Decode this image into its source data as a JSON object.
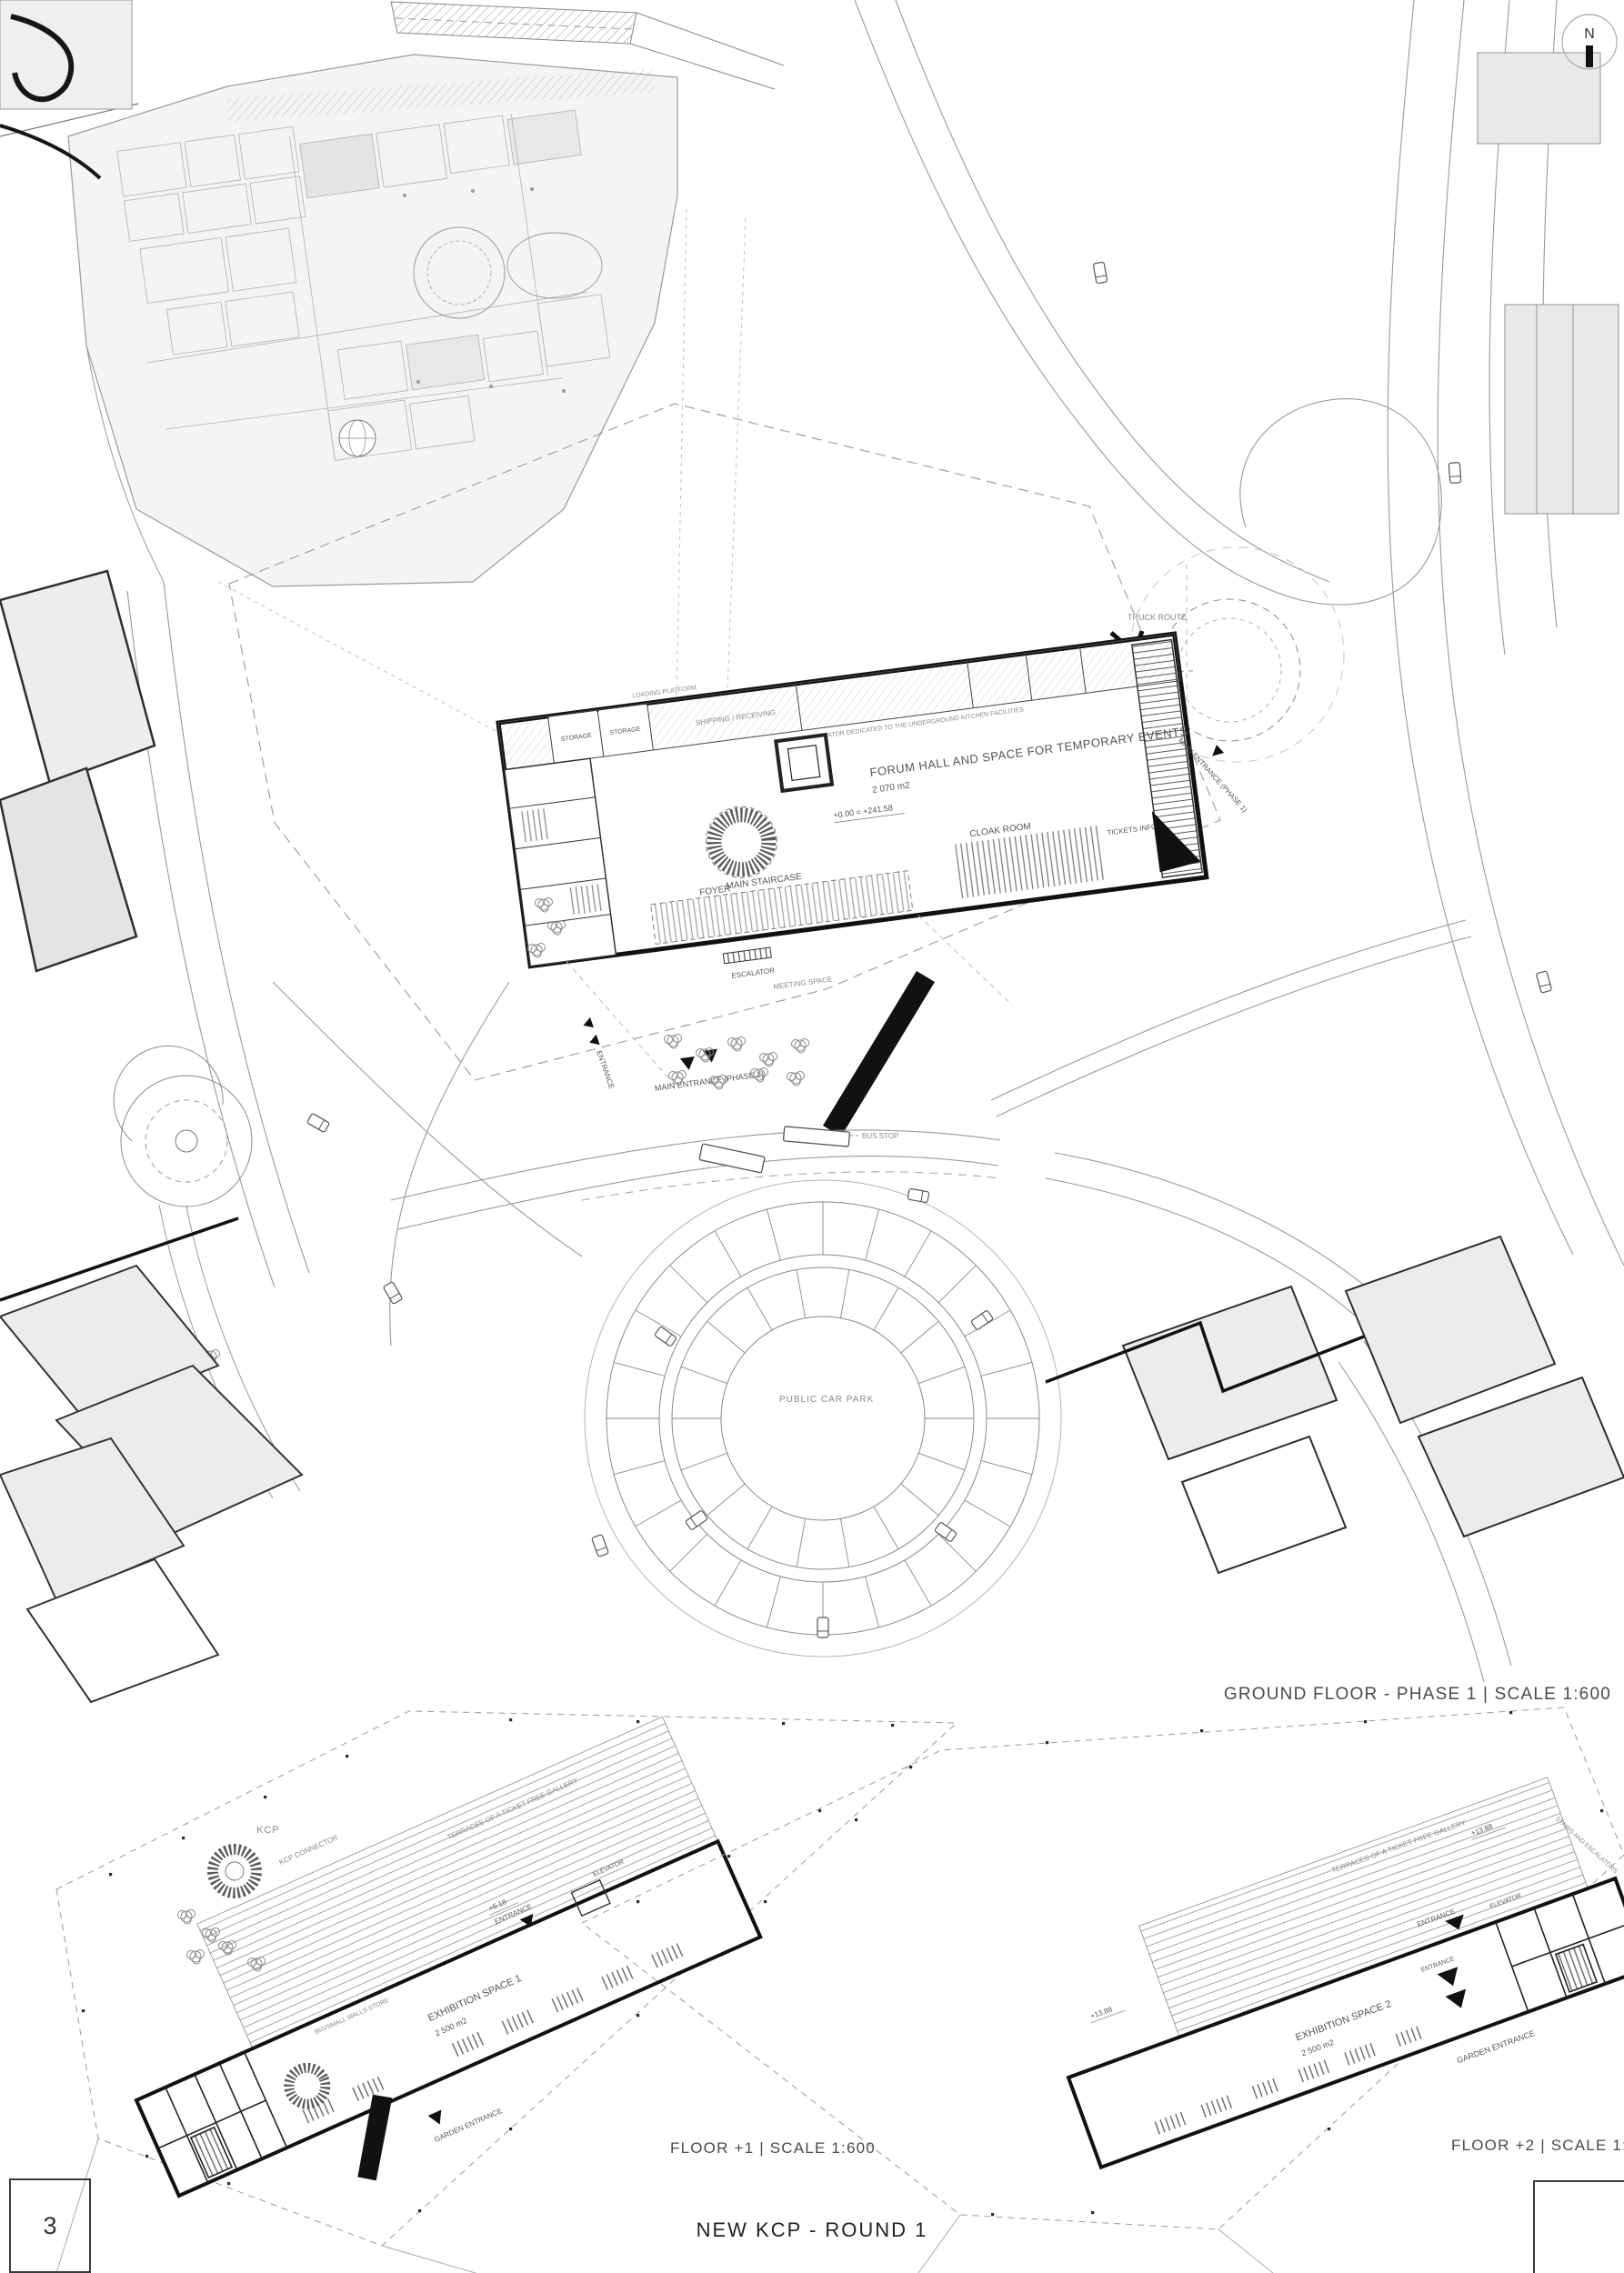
{
  "page": {
    "number": "3",
    "project_title": "NEW KCP - ROUND 1",
    "north_label": "N"
  },
  "colors": {
    "paper": "#ffffff",
    "ink": "#1a1a1a",
    "grey_line": "#8a8a8a",
    "light_fill": "#ececec"
  },
  "ground_floor": {
    "caption": "GROUND FLOOR - PHASE 1  |  SCALE 1:600",
    "labels": {
      "truck_route": "TRUCK ROUTE",
      "forum_hall": "FORUM HALL AND SPACE FOR TEMPORARY EVENTS",
      "forum_hall_area": "2 070 m2",
      "level_datum": "+0.00 = +241.58",
      "foyer": "FOYER",
      "main_staircase": "MAIN STAIRCASE",
      "cloak_room": "CLOAK ROOM",
      "tickets_info": "TICKETS INFO",
      "escalator": "ESCALATOR",
      "meeting_space": "MEETING SPACE",
      "storage": "STORAGE",
      "shipping": "SHIPPING / RECEIVING",
      "kitchen_elevator": "ELEVATOR DEDICATED TO THE UNDERGROUND KITCHEN FACILITIES",
      "loading_platform": "LOADING PLATFORM",
      "main_entrance": "MAIN ENTRANCE (PHASE 1)",
      "entrance": "ENTRANCE",
      "bus_stop": "BUS STOP",
      "public_car_park": "PUBLIC CAR PARK"
    }
  },
  "floor1": {
    "caption": "FLOOR +1  |  SCALE 1:600",
    "labels": {
      "kcp": "KCP",
      "kcp_connector": "KCP CONNECTOR",
      "level": "+5.18",
      "entrance": "ENTRANCE",
      "exhibition": "EXHIBITION SPACE 1",
      "exhibition_area": "2 500 m2",
      "terraces": "TERRACES OF A TICKET FREE GALLERY",
      "elevator": "ELEVATOR",
      "walls_store": "BIG/SMALL WALLS STORE",
      "garden_entrance": "GARDEN ENTRANCE"
    }
  },
  "floor2": {
    "caption": "FLOOR +2  |  SCALE 1:600",
    "labels": {
      "terraces": "TERRACES OF A TICKET FREE GALLERY",
      "level": "+13.88",
      "entrance": "ENTRANCE",
      "elevator": "ELEVATOR",
      "stairs": "STAIRS AND ESCALATORS",
      "exhibition": "EXHIBITION SPACE 2",
      "exhibition_area": "2 500 m2",
      "garden_entrance": "GARDEN ENTRANCE"
    }
  }
}
